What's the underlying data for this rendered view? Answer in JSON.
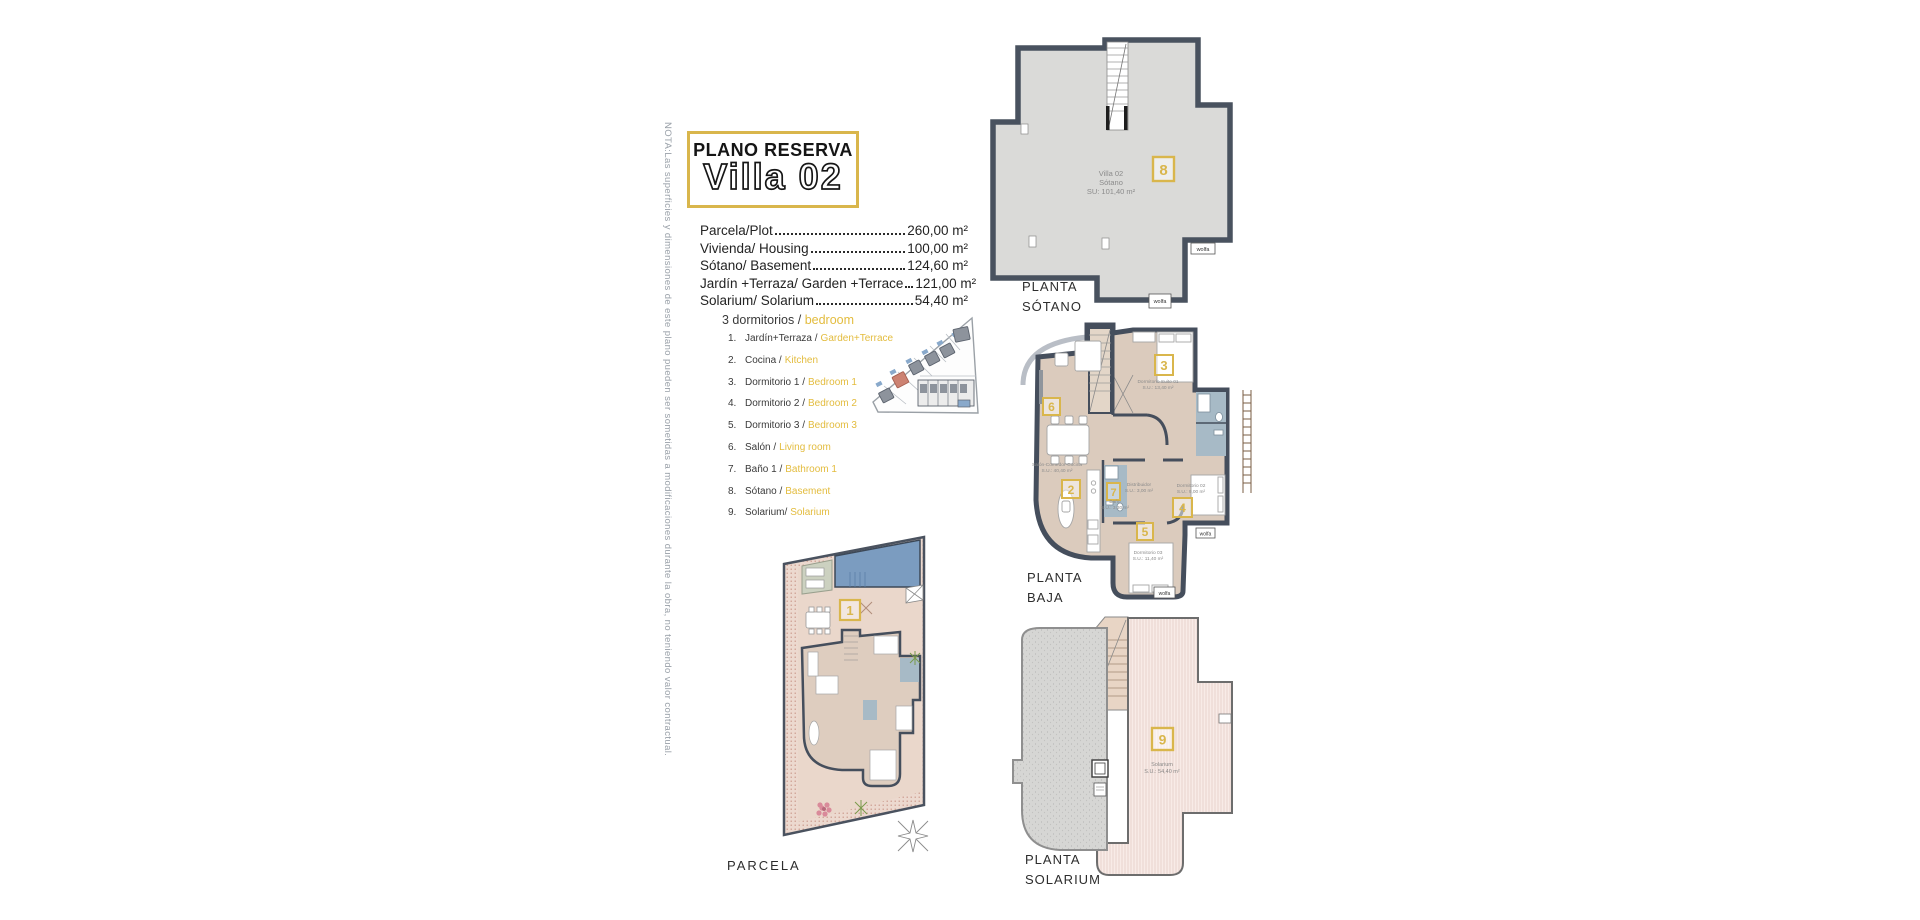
{
  "note_vertical": "NOTA:Las superficies y dimensiones de este plano pueden ser sometidas a modificaciones durante la obra, no teniendo valor contractual.",
  "title": {
    "line1": "PLANO RESERVA",
    "line2": "Villa 02"
  },
  "measurements": [
    {
      "label": "Parcela/Plot",
      "value": "260,00 m²"
    },
    {
      "label": "Vivienda/ Housing",
      "value": "100,00 m²"
    },
    {
      "label": "Sótano/ Basement",
      "value": "124,60 m²"
    },
    {
      "label": "Jardín +Terraza/ Garden +Terrace",
      "value": "121,00 m²"
    },
    {
      "label": "Solarium/ Solarium",
      "value": "54,40 m²"
    }
  ],
  "legend": {
    "heading_es": "3 dormitorios /",
    "heading_en": "bedroom",
    "items": [
      {
        "num": "1.",
        "es": "Jardín+Terraza /",
        "en": "Garden+Terrace"
      },
      {
        "num": "2.",
        "es": "Cocina /",
        "en": "Kitchen"
      },
      {
        "num": "3.",
        "es": "Dormitorio 1 /",
        "en": "Bedroom 1"
      },
      {
        "num": "4.",
        "es": "Dormitorio 2 /",
        "en": "Bedroom 2"
      },
      {
        "num": "5.",
        "es": "Dormitorio 3 /",
        "en": "Bedroom 3"
      },
      {
        "num": "6.",
        "es": "Salón /",
        "en": "Living room"
      },
      {
        "num": "7.",
        "es": "Baño 1 /",
        "en": "Bathroom 1"
      },
      {
        "num": "8.",
        "es": "Sótano /",
        "en": "Basement"
      },
      {
        "num": "9.",
        "es": "Solarium/",
        "en": "Solarium"
      }
    ]
  },
  "plans": {
    "sotano": {
      "label1": "PLANTA",
      "label2": "SÓTANO",
      "num": "8",
      "info1": "Villa 02",
      "info2": "Sótano",
      "info3": "SU: 101,40 m²",
      "logo": "wolfa"
    },
    "baja": {
      "label1": "PLANTA",
      "label2": "BAJA",
      "logo": "wolfa",
      "nums": {
        "n2": "2",
        "n3": "3",
        "n4": "4",
        "n5": "5",
        "n6": "6",
        "n7": "7"
      },
      "rooms": {
        "suite": {
          "name": "Dormitorio Suite 01",
          "area": "S.U.: 13,40 m²"
        },
        "salon": {
          "name": "Salón-Comedor-Cocina",
          "area": "S.U.: 40,40 m²"
        },
        "distribuidor": {
          "name": "Distribuidor",
          "area": "S.U.: 3,00 m²"
        },
        "bano": {
          "name": "Baño",
          "area": "S.U.: 3,30 m²"
        },
        "dorm2": {
          "name": "Dormitorio 02",
          "area": "S.U.: 9,00 m²"
        },
        "dorm3": {
          "name": "Dormitorio 03",
          "area": "S.U.: 11,40 m²"
        }
      }
    },
    "parcela": {
      "label": "PARCELA",
      "num": "1"
    },
    "solarium": {
      "label1": "PLANTA",
      "label2": "SOLARIUM",
      "num": "9",
      "info1": "Solarium",
      "info2": "S.U.: 54,40 m²"
    }
  },
  "colors": {
    "accent_yellow": "#D9B64C",
    "legend_yellow": "#E3BC3E",
    "wall_dark": "#49525F",
    "basement_floor": "#DADAD8",
    "floor_beige": "#DBCBBD",
    "bath_blue": "#A7BAC6",
    "ground_pink": "#ECD9CF",
    "pool_blue": "#7B9CC0",
    "roof_gray": "#D6D6D4",
    "plot_highlight": "#D08676"
  }
}
